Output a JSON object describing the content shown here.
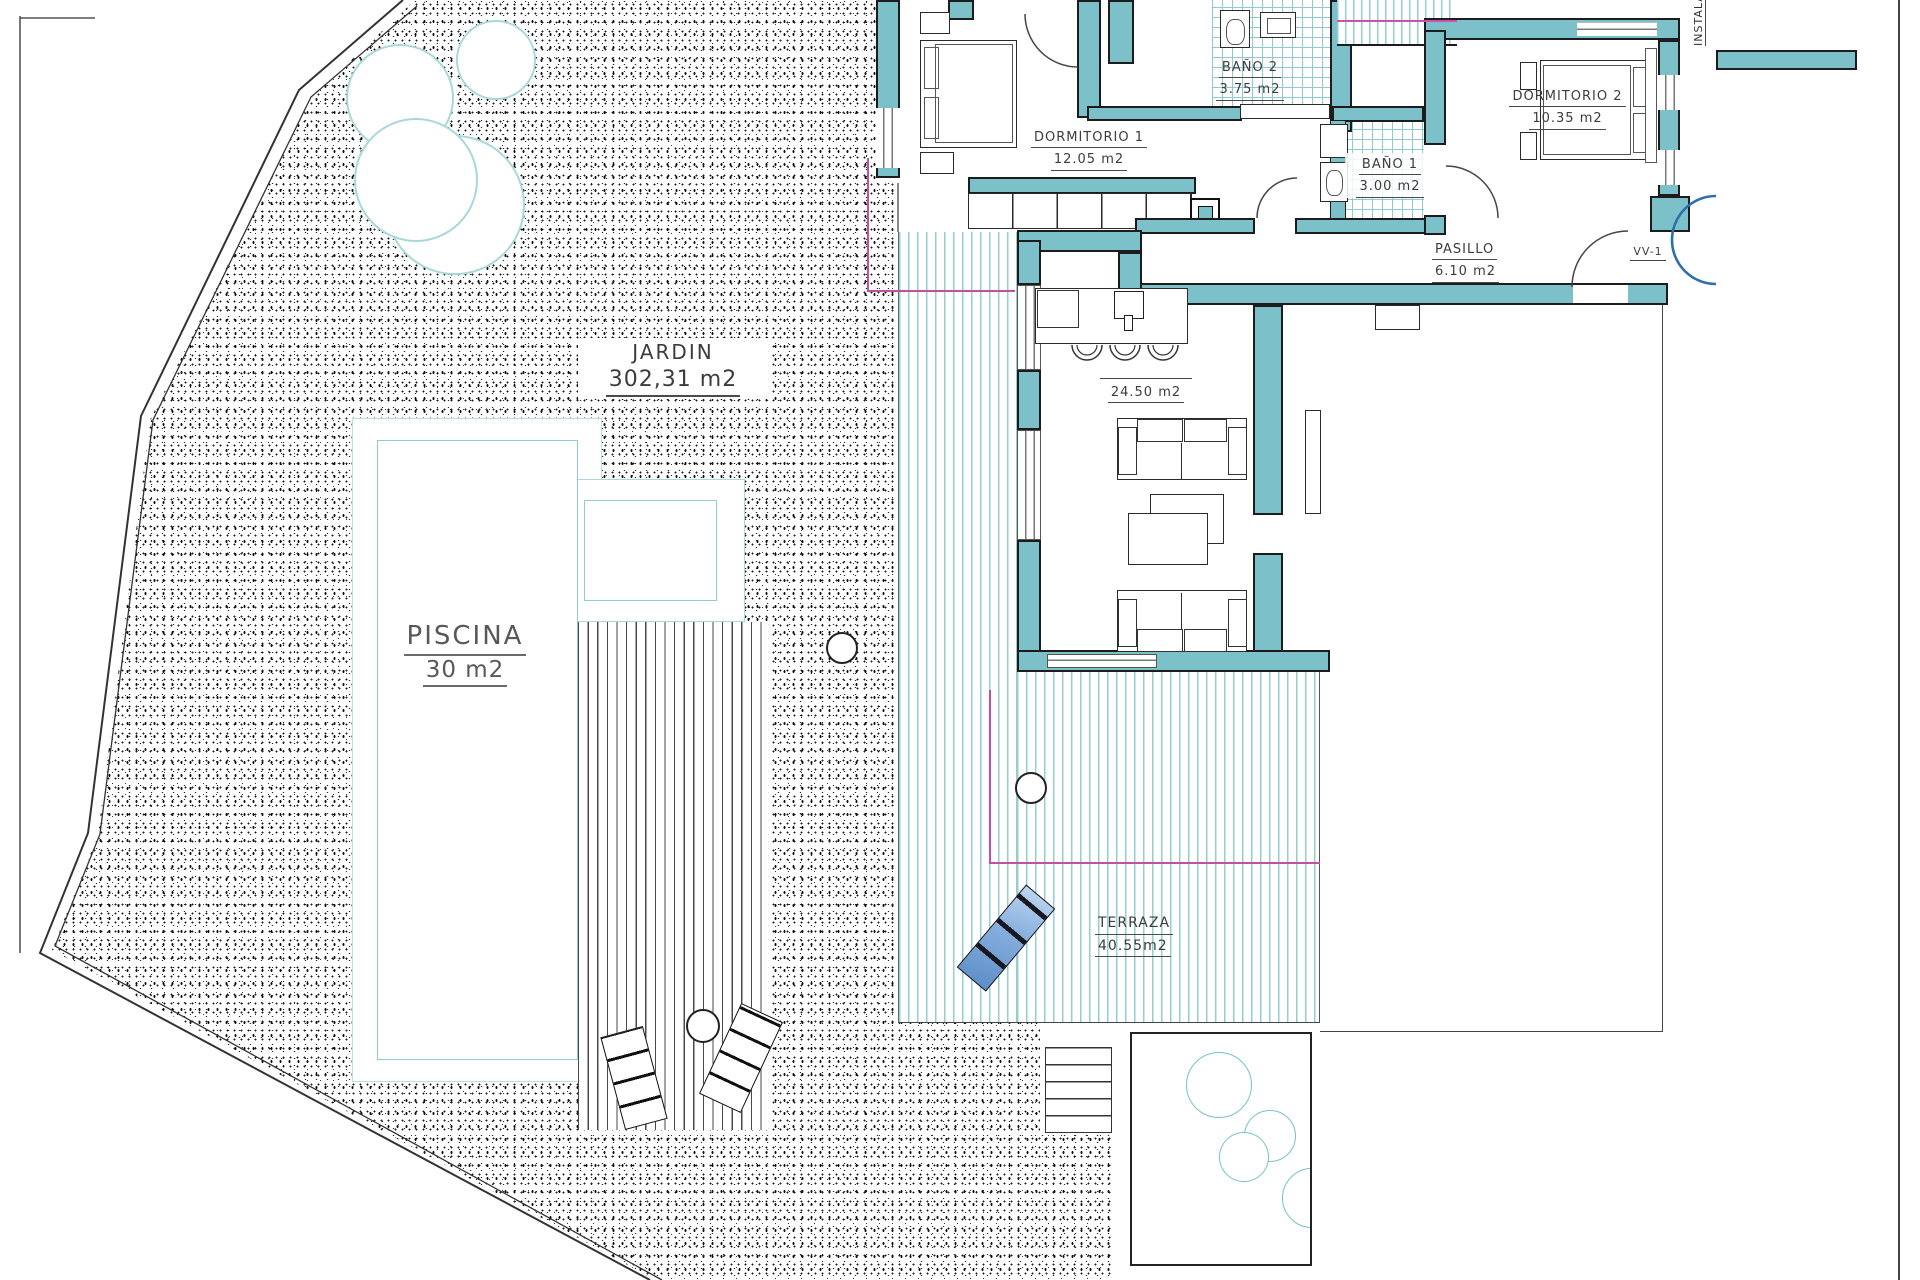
{
  "plan": {
    "title": "Villa ground floor plan with garden and pool",
    "rooms": [
      {
        "id": "jardin",
        "name": "JARDIN",
        "area": "302,31 m2"
      },
      {
        "id": "piscina",
        "name": "PISCINA",
        "area": "30 m2"
      },
      {
        "id": "terraza",
        "name": "TERRAZA",
        "area": "40.55m2"
      },
      {
        "id": "dormitorio1",
        "name": "DORMITORIO 1",
        "area": "12.05 m2"
      },
      {
        "id": "bano2",
        "name": "BAÑO 2",
        "area": "3.75 m2"
      },
      {
        "id": "bano1",
        "name": "BAÑO 1",
        "area": "3.00 m2"
      },
      {
        "id": "dormitorio2",
        "name": "DORMITORIO 2",
        "area": "10.35 m2"
      },
      {
        "id": "pasillo",
        "name": "PASILLO",
        "area": "6.10 m2"
      },
      {
        "id": "salon",
        "name": "",
        "area": "24.50 m2"
      },
      {
        "id": "vv1",
        "name": "VV-1",
        "area": ""
      },
      {
        "id": "instalaciones",
        "name": "INSTALA",
        "area": ""
      }
    ],
    "colors": {
      "wall_teal": "#7cc0ca",
      "stripe_teal": "#93ced3",
      "magenta_line": "#c0519f",
      "blue_arc": "#2c6fad",
      "lounger_blue": "#86aede",
      "text_gray": "#3c3c3c"
    }
  }
}
